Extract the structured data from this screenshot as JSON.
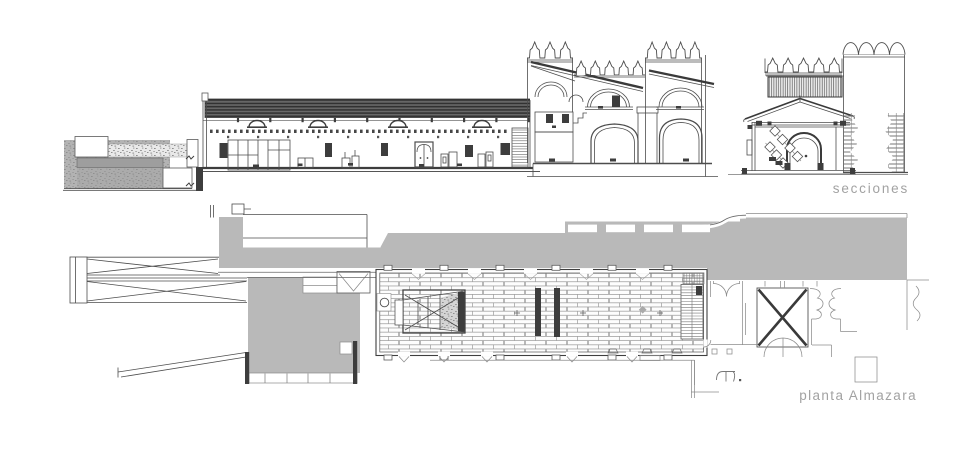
{
  "labels": {
    "sections": "secciones",
    "plan": "planta Almazara"
  },
  "colors": {
    "poche_gray": "#b9b9b9",
    "label_gray": "#a2a2a2",
    "ink": "#4d4d4d",
    "dark_fill": "#3d3d3d",
    "roof_band": "#585858",
    "background": "#ffffff"
  }
}
